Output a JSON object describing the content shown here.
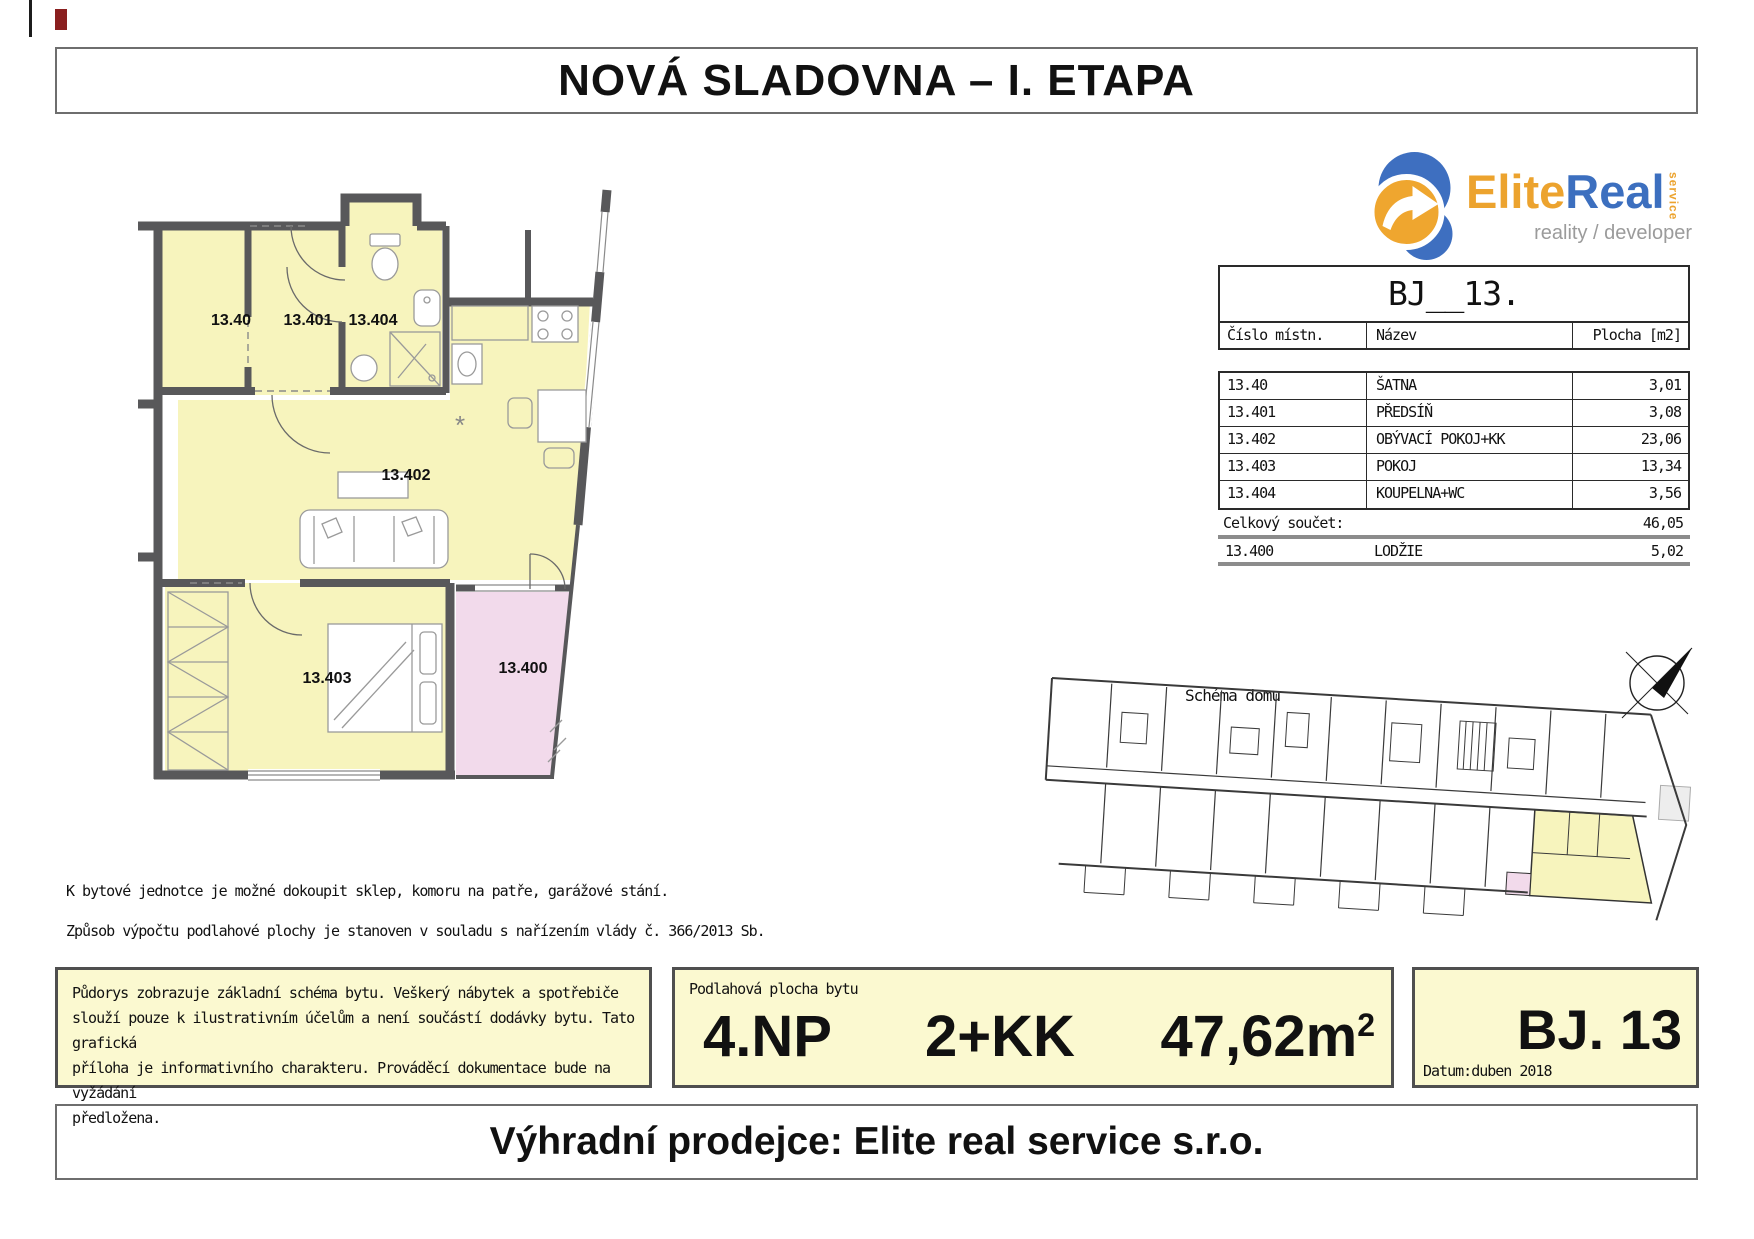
{
  "page": {
    "title": "NOVÁ SLADOVNA – I. ETAPA",
    "footer": "Výhradní prodejce: Elite real service s.r.o."
  },
  "logo": {
    "brand_primary": "Elite",
    "brand_secondary": "Real",
    "brand_service": "service",
    "tagline": "reality / developer",
    "color_orange": "#eca32e",
    "color_blue": "#3c6fbf"
  },
  "unit_table": {
    "title": "BJ__13.",
    "columns": [
      "Číslo místn.",
      "Název",
      "Plocha [m2]"
    ],
    "rows": [
      {
        "id": "13.40",
        "name": "ŠATNA",
        "area": "3,01"
      },
      {
        "id": "13.401",
        "name": "PŘEDSÍŇ",
        "area": "3,08"
      },
      {
        "id": "13.402",
        "name": "OBÝVACÍ POKOJ+KK",
        "area": "23,06"
      },
      {
        "id": "13.403",
        "name": "POKOJ",
        "area": "13,34"
      },
      {
        "id": "13.404",
        "name": "KOUPELNA+WC",
        "area": "3,56"
      }
    ],
    "total_label": "Celkový součet:",
    "total_value": "46,05",
    "extra": {
      "id": "13.400",
      "name": "LODŽIE",
      "area": "5,02"
    }
  },
  "floor_plan": {
    "rooms": {
      "satna": "13.40",
      "predsin": "13.401",
      "koupelna": "13.404",
      "obyvaci": "13.402",
      "pokoj": "13.403",
      "lodzie": "13.400"
    },
    "kitchen_symbol": "*",
    "room_fill": "#f7f4bd",
    "loggia_fill": "#f2daeb",
    "wall_color": "#58585a"
  },
  "schema": {
    "label": "Schéma domu"
  },
  "notes": {
    "line1": "K bytové jednotce je možné dokoupit sklep, komoru na patře, garážové stání.",
    "line2": "Způsob výpočtu podlahové plochy je stanoven v souladu s nařízením vlády č. 366/2013 Sb."
  },
  "disclaimer": {
    "lines": [
      "Půdorys zobrazuje základní schéma bytu. Veškerý nábytek a spotřebiče",
      "slouží pouze k ilustrativním účelům a není součástí dodávky bytu. Tato grafická",
      "příloha je informativního charakteru. Prováděcí dokumentace bude na vyžádání",
      "předložena."
    ]
  },
  "summary": {
    "label": "Podlahová plocha bytu",
    "floor": "4.NP",
    "layout": "2+KK",
    "area_value": "47,62m",
    "area_sup": "2",
    "unit_id": "BJ. 13",
    "date_label": "Datum:",
    "date_value": "duben 2018"
  }
}
